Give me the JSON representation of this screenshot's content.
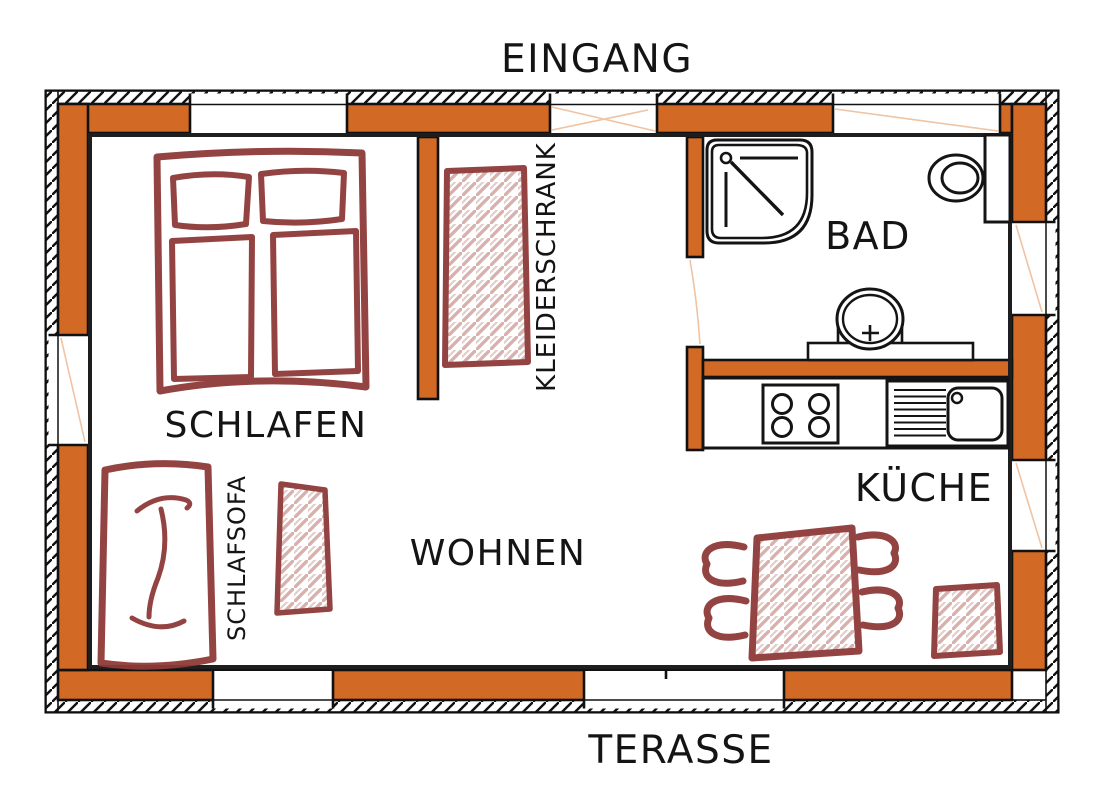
{
  "plan": {
    "title_top": "EINGANG",
    "title_bottom": "TERASSE",
    "rooms": {
      "bedroom": "SCHLAFEN",
      "bathroom": "BAD",
      "kitchen": "KÜCHE",
      "living": "WOHNEN"
    },
    "furniture": {
      "wardrobe": "KLEIDERSCHRANK",
      "sleeper_sofa": "SCHLAFSOFA"
    },
    "colors": {
      "wall_fill": "#d26a26",
      "sketch_stroke": "#8e3b38",
      "sketch_hatch": "#b46a64",
      "outline": "#141414",
      "door_swing": "#f0c3a2"
    }
  }
}
